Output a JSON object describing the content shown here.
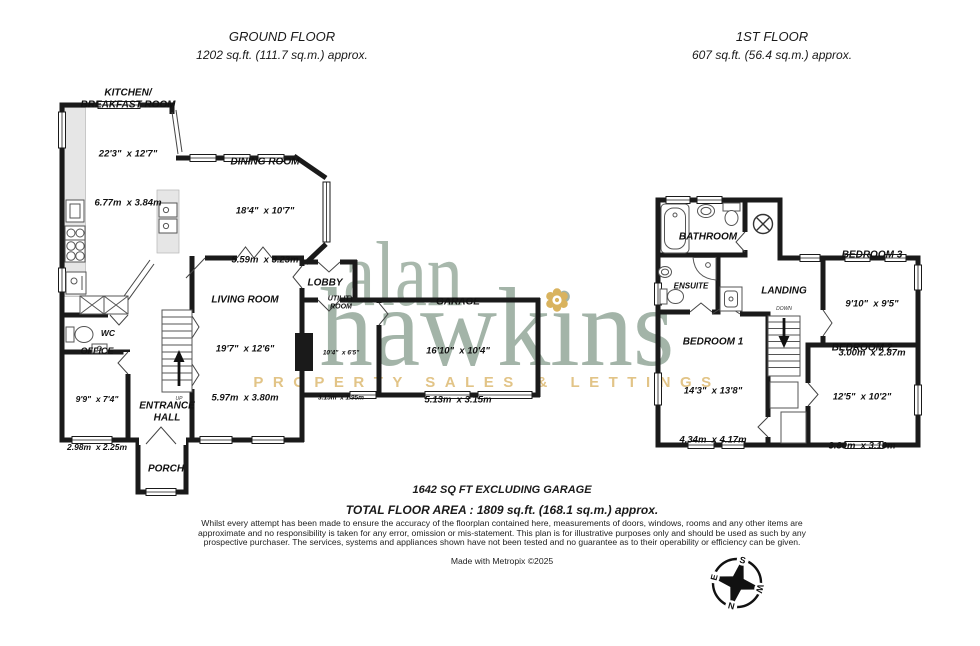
{
  "headers": {
    "ground_floor": {
      "title": "GROUND FLOOR",
      "area": "1202 sq.ft. (111.7 sq.m.) approx."
    },
    "first_floor": {
      "title": "1ST FLOOR",
      "area": "607 sq.ft. (56.4 sq.m.) approx."
    }
  },
  "watermark": {
    "line1": "alan",
    "line2": "hawkins",
    "tagline": "PROPERTY SALES & LETTINGS",
    "text_color": "#a3b4a8",
    "accent_color": "#e2c487"
  },
  "ground_floor": {
    "kitchen": {
      "name": "KITCHEN/\nBREAKFAST ROOM",
      "dim_ft": "22'3\"  x 12'7\"",
      "dim_m": "6.77m  x 3.84m"
    },
    "dining": {
      "name": "DINING ROOM",
      "dim_ft": "18'4\"  x 10'7\"",
      "dim_m": "5.59m  x 3.23m"
    },
    "lobby": {
      "name": "LOBBY"
    },
    "living": {
      "name": "LIVING ROOM",
      "dim_ft": "19'7\"  x 12'6\"",
      "dim_m": "5.97m  x 3.80m"
    },
    "utility": {
      "name": "UTILITY\nROOM",
      "dim_ft": "10'4\"  x 6'5\"",
      "dim_m": "3.15m  x 1.95m"
    },
    "garage": {
      "name": "GARAGE",
      "dim_ft": "16'10\"  x 10'4\"",
      "dim_m": "5.13m  x 3.15m"
    },
    "wc": {
      "name": "WC"
    },
    "office": {
      "name": "OFFICE",
      "dim_ft": "9'9\"  x 7'4\"",
      "dim_m": "2.98m  x 2.25m"
    },
    "entrance": {
      "name": "ENTRANCE\nHALL"
    },
    "porch": {
      "name": "PORCH"
    },
    "stairs_label": "UP"
  },
  "first_floor": {
    "bathroom": {
      "name": "BATHROOM"
    },
    "ensuite": {
      "name": "ENSUITE"
    },
    "landing": {
      "name": "LANDING"
    },
    "bedroom1": {
      "name": "BEDROOM 1",
      "dim_ft": "14'3\"  x 13'8\"",
      "dim_m": "4.34m  x 4.17m"
    },
    "bedroom2": {
      "name": "BEDROOM 2",
      "dim_ft": "12'5\"  x 10'2\"",
      "dim_m": "3.80m  x 3.10m"
    },
    "bedroom3": {
      "name": "BEDROOM 3",
      "dim_ft": "9'10\"  x 9'5\"",
      "dim_m": "3.00m  x 2.87m"
    },
    "stairs_label": "DOWN"
  },
  "footer": {
    "garage_note": "1642 SQ FT EXCLUDING GARAGE",
    "total_area": "TOTAL FLOOR AREA : 1809 sq.ft. (168.1 sq.m.) approx.",
    "disclaimer": "Whilst every attempt has been made to ensure the accuracy of the floorplan contained here, measurements of doors, windows, rooms and any other items are approximate and no responsibility is taken for any error, omission or mis-statement. This plan is for illustrative purposes only and should be used as such by any prospective purchaser. The services, systems and appliances shown have not been tested and no guarantee as to their operability or efficiency can be given.",
    "credit": "Made with Metropix ©2025"
  },
  "compass": {
    "north": "N",
    "south": "S",
    "east": "E",
    "west": "W"
  }
}
